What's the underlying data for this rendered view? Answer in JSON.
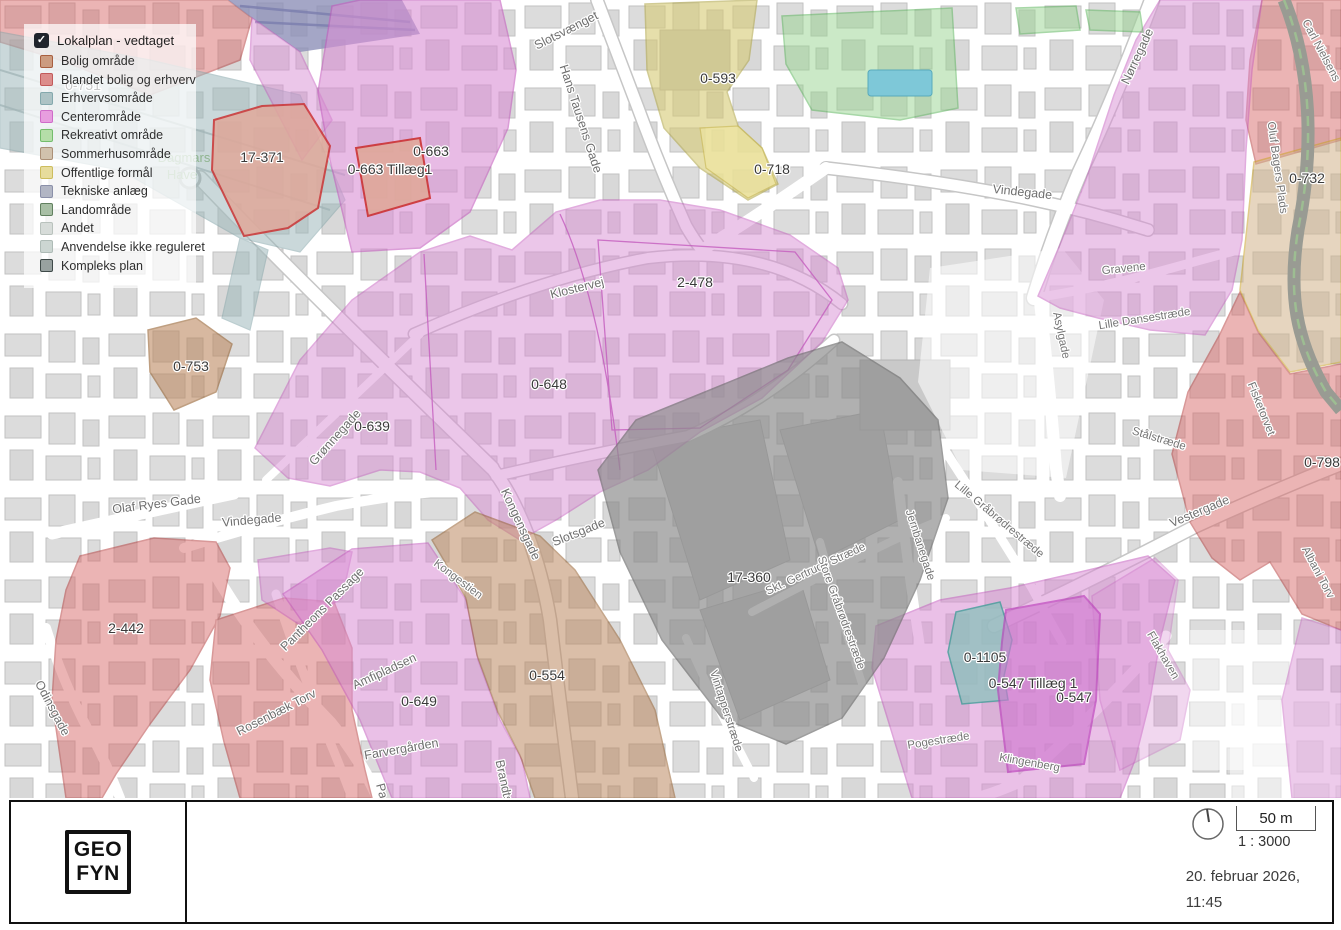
{
  "legend": {
    "title": "Lokalplan - vedtaget",
    "checkbox_checked": true,
    "check_glyph": "✓",
    "items": [
      {
        "label": "Bolig område",
        "fill": "#cc9c80",
        "border": "#a85f3f"
      },
      {
        "label": "Blandet bolig og erhverv",
        "fill": "#dc8e8c",
        "border": "#c25b5b"
      },
      {
        "label": "Erhvervsområde",
        "fill": "#adc3c5",
        "border": "#84a9ad"
      },
      {
        "label": "Centerområde",
        "fill": "#e79edf",
        "border": "#cf6cc9"
      },
      {
        "label": "Rekreativt område",
        "fill": "#b5dea8",
        "border": "#74bd6c"
      },
      {
        "label": "Sommerhusområde",
        "fill": "#d1c2ad",
        "border": "#ab9077"
      },
      {
        "label": "Offentlige formål",
        "fill": "#e7dc9c",
        "border": "#cdbd5e"
      },
      {
        "label": "Tekniske anlæg",
        "fill": "#b2b6c4",
        "border": "#8b90a9"
      },
      {
        "label": "Landområde",
        "fill": "#a8bfa5",
        "border": "#61805f"
      },
      {
        "label": "Andet",
        "fill": "#d7dcd9",
        "border": "#b9c2bd"
      },
      {
        "label": "Anvendelse ikke reguleret",
        "fill": "#ccd6d2",
        "border": "#aebbb6"
      },
      {
        "label": "Kompleks plan",
        "fill": "#98a1a0",
        "border": "#3f4a49"
      }
    ]
  },
  "map": {
    "plans": {
      "l17371": "17-371",
      "l0751": "0-751",
      "l0663": "0-663",
      "l0663t": "0-663 Tillæg1",
      "l0593": "0-593",
      "l0718": "0-718",
      "l0732": "0-732",
      "l2478": "2-478",
      "l0648": "0-648",
      "l0639": "0-639",
      "l0753": "0-753",
      "l2442": "2-442",
      "l0649": "0-649",
      "l0554": "0-554",
      "l17360": "17-360",
      "l0798": "0-798",
      "l01105": "0-1105",
      "l0547t": "0-547 Tillæg 1",
      "l0547": "0-547"
    },
    "streets": {
      "slotsvaenget": "Slotsvænget",
      "hans_tausens": "Hans Tausens Gade",
      "klostervej": "Klostervej",
      "norregade": "Nørregade",
      "vindegade_r": "Vindegade",
      "vindegade_l": "Vindegade",
      "olaf_ryes": "Olaf Ryes Gade",
      "gronnegade": "Grønnegade",
      "kongensgade": "Kongensgade",
      "slotsgade": "Slotsgade",
      "kongestien": "Kongestien",
      "amfipladsen": "Amfipladsen",
      "farvergaarden": "Farvergården",
      "brandts": "Brandts",
      "pantheonsgade": "Pa",
      "pantheons_passage": "Pantheons Passage",
      "odinsgade": "Odinsgade",
      "rosenbaek": "Rosenbæk Torv",
      "skt_gertruds": "Skt. Gertruds Stræde",
      "store_graabrodre": "Store Gråbrødrestræde",
      "vintapper": "Vintapperstræde",
      "jernbanegade": "Jernbanegade",
      "lille_graabrodre": "Lille Gråbrødrestræde",
      "asylgade": "Asylgade",
      "staalstraede": "Stålstræde",
      "gravene": "Gravene",
      "lille_dansestraede": "Lille Dansestræde",
      "vestergade": "Vestergade",
      "fisketorvet": "Fisketorvet",
      "albani_torv": "Albani Torv",
      "flakhaven": "Flakhaven",
      "klingenberg": "Klingenberg",
      "pogestraede": "Pogestræde",
      "carl_nielsens": "Carl Nielsens",
      "oluf_bagers": "Oluf Bagers Plads"
    },
    "places": {
      "dagmars": "Dagmars",
      "have": "Have"
    }
  },
  "colors": {
    "center_zone": "#d98ed4",
    "center_zone_stroke": "#c45cbe",
    "mixed_zone": "#d96c6c",
    "mixed_zone_stroke": "#b23333",
    "residential_zone": "#bd8a62",
    "residential_zone_stroke": "#96602f",
    "public_zone": "#d6ca74",
    "public_zone_light": "#efe6a0",
    "recreation_zone": "#98d490",
    "industry_rail": "#9fbabc",
    "complex_zone": "#8c8c8c",
    "summerhouse_zone": "#d2b48c",
    "technical_zone": "#8d90b8",
    "teal_parcel": "#8fc0bd",
    "parcel_salmon": "#e0a89a",
    "parcel_outline_red": "#cc3333",
    "building_gray": "#dcdcdc",
    "road_white": "#ffffff",
    "dark_road": "#999b93",
    "pool_blue": "#7ec8d8"
  },
  "footer": {
    "logo_line1": "GEO",
    "logo_line2": "FYN",
    "scale_bar_label": "50 m",
    "scale_ratio": "1 : 3000",
    "date_line1": "20. februar 2026,",
    "date_line2": "11:45"
  }
}
